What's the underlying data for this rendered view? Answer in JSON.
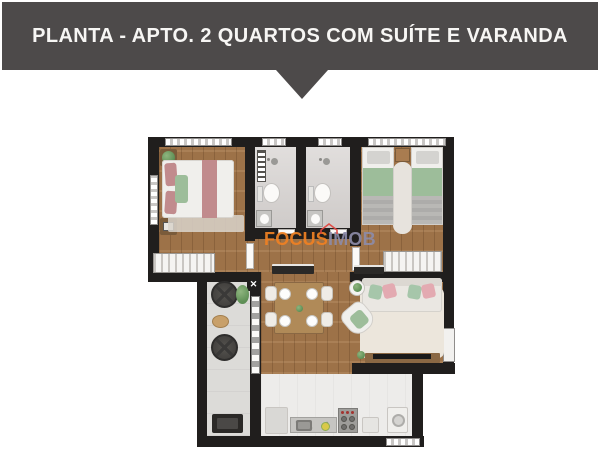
{
  "banner": {
    "title": "PLANTA - APTO. 2 QUARTOS COM SUÍTE E VARANDA"
  },
  "watermark": {
    "focus": "FOCUS",
    "imob": "IMOB"
  },
  "palette": {
    "banner_bg": "#4d4a4a",
    "banner_text": "#f7f6f4",
    "wall": "#201e1d",
    "wood": "#a5784c",
    "wood_table": "#b08a58",
    "tile_bath": "#d7d3d1",
    "tile_balcony": "#dcdbd8",
    "tile_kitchen": "#edecea",
    "rug": "#ece6dc",
    "white_furniture": "#f0efec",
    "pink": "#c18b8d",
    "pink_light": "#e3aab1",
    "green": "#9dbd9a",
    "wood_furniture": "#8a6844",
    "dark_furniture": "#2b2927",
    "granite": "#c6c5c2",
    "watermark_orange": "#f08123",
    "watermark_gray": "#8d8ca8",
    "watermark_house": "#e2453f",
    "window": "#c9c7c5"
  },
  "plan": {
    "rooms": [
      "suite",
      "bathroom-1",
      "bathroom-2",
      "bedroom-2",
      "dining",
      "living",
      "balcony",
      "kitchen"
    ]
  }
}
